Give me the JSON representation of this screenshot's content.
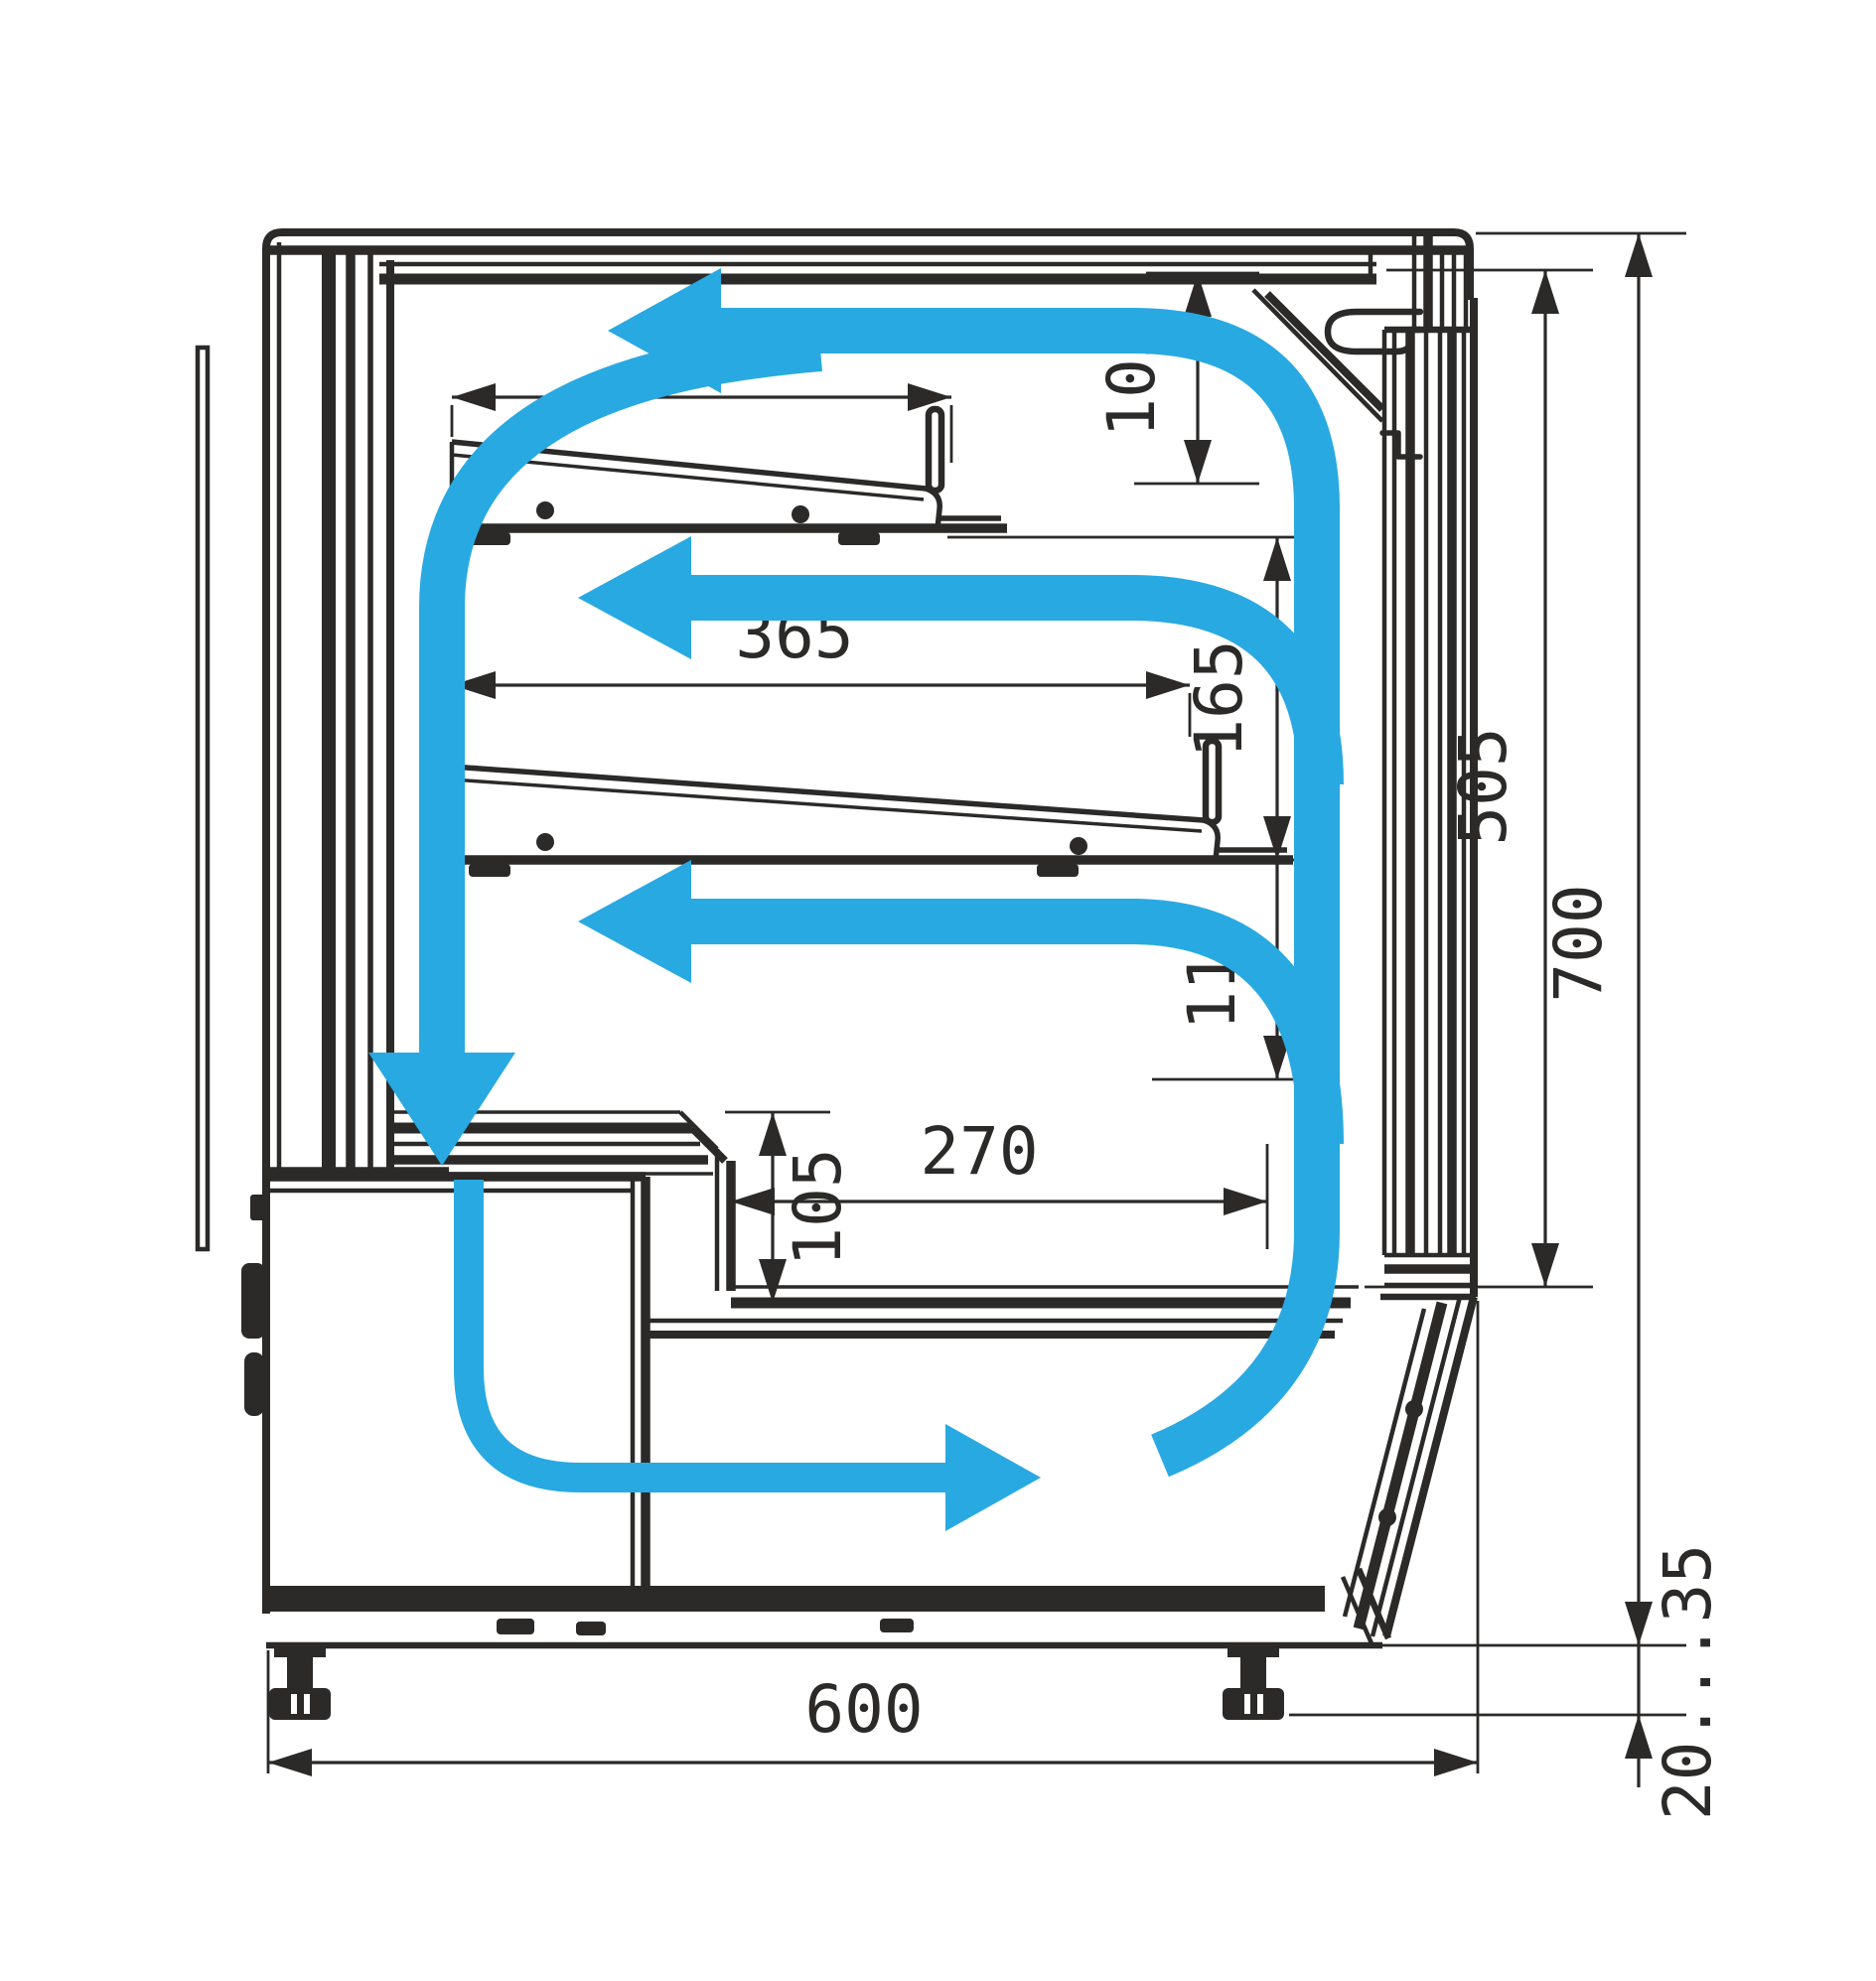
{
  "diagram": {
    "type": "technical-cross-section",
    "subject": "refrigerated-display-case-airflow-and-dimensions",
    "units_implied": "mm",
    "colors": {
      "line": "#2B2A29",
      "airflow": "#29A9E1",
      "background": "#FFFFFF"
    },
    "dimensions": {
      "upper_shelf_depth": "245",
      "top_clearance": "105",
      "lower_shelf_depth": "365",
      "shelf_gap": "165",
      "under_shelf_gap": "110",
      "well_depth": "270",
      "well_front_height": "105",
      "display_opening_height": "505",
      "overall_interior_height": "700",
      "case_depth": "600",
      "foot_adjustment_range": "20...35"
    },
    "airflow": {
      "arrows": [
        "top-stream-toward-back",
        "mid-stream-above-lower-shelf",
        "low-stream-above-deck",
        "down-stream-along-back-wall",
        "bottom-stream-toward-front"
      ]
    }
  }
}
